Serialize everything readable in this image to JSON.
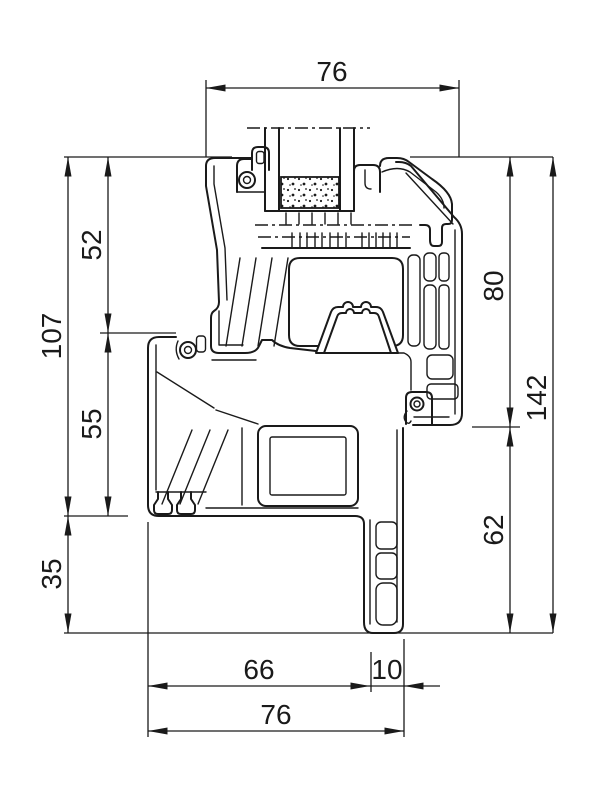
{
  "drawing": {
    "type": "technical-cross-section",
    "subject": "PVC window frame and sash profile section with glazing",
    "background": "#ffffff",
    "line_color": "#1a1a1a",
    "dims": {
      "top_width": "76",
      "left_upper": "52",
      "left_total": "107",
      "left_middle": "55",
      "left_bottom": "35",
      "right_upper": "80",
      "right_total": "142",
      "right_lower": "62",
      "bottom_frame": "66",
      "bottom_step": "10",
      "bottom_total": "76"
    }
  }
}
